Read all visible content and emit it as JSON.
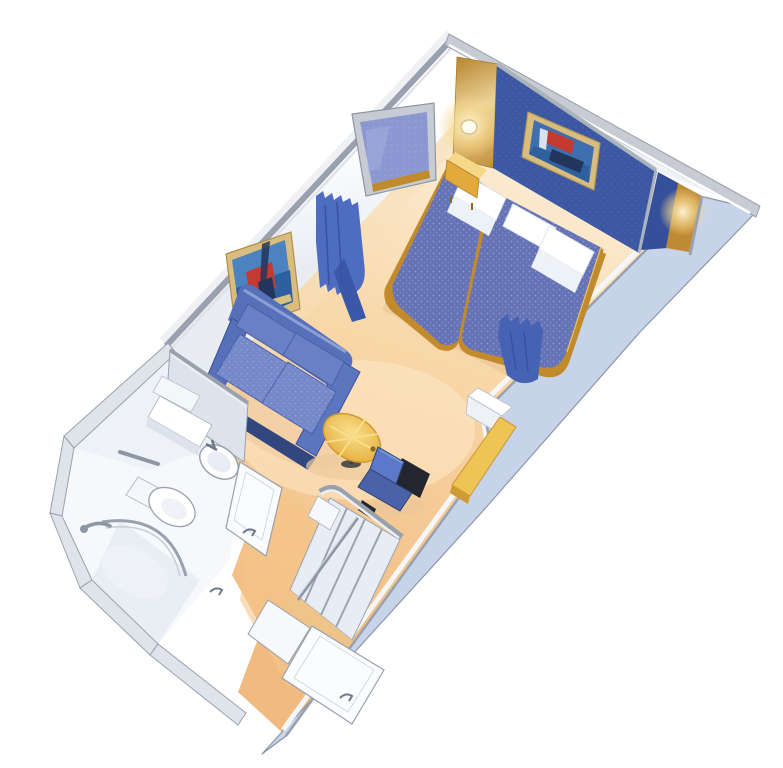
{
  "meta": {
    "title": "Interior stateroom 3D cutaway floor plan",
    "scene_type": "cruise-ship-cabin-illustration",
    "visible_text": ""
  },
  "palette": {
    "background": "#ffffff",
    "floor_light": "#fdf1de",
    "floor_mid": "#f8d7a8",
    "floor_deep": "#f1ba80",
    "corridor_carpet": "#f5c488",
    "outer_wall": "#c7d3e9",
    "wall_trim": "#98a1ad",
    "wall_trim_light": "#c7ccd4",
    "inner_wall_white": "#ffffff",
    "headboard_wall": "#3c58a3",
    "headboard_return": "#35509a",
    "wood_gold": "#c9973f",
    "gold_light": "#f6d988",
    "nightstand": "#e2a93c",
    "bedspread": "#6573b6",
    "bed_base_gold": "#c08a2d",
    "pillow": "#ffffff",
    "sheet": "#edf1f8",
    "sofa": "#5671b9",
    "sofa_cushion": "#7589ca",
    "sofa_dark": "#33477f",
    "curtain": "#4e6cc0",
    "curtain_dark": "#3a57a8",
    "table_top": "#efc355",
    "chair": "#5b79c8",
    "chair_frame": "#23262f",
    "desk": "#eec455",
    "fixture_white": "#ffffff",
    "fixture_shade": "#e2e8f1",
    "fixture_line": "#8d96a4",
    "art_frame": "#d9bd7e",
    "art_sky": "#4c82c0",
    "art_sea": "#2e5f9e",
    "art_red": "#c53a30",
    "art_dark": "#22365c",
    "sconce_glow": "#ffe9b8"
  },
  "objects": [
    {
      "id": "headboard-wall",
      "label": "navy headboard wall with framed nautical print and two wall sconces"
    },
    {
      "id": "bed-left",
      "label": "twin bed, blue spread, white pillow"
    },
    {
      "id": "bed-right",
      "label": "twin bed, blue spread, two white pillows, blue curtain over foot"
    },
    {
      "id": "nightstand",
      "label": "wooden nightstand"
    },
    {
      "id": "wall-mirror",
      "label": "framed mirror reflecting bed"
    },
    {
      "id": "wall-artwork",
      "label": "framed sailboat painting on left wall"
    },
    {
      "id": "divider-curtain",
      "label": "blue privacy curtain"
    },
    {
      "id": "loveseat-sofa",
      "label": "blue two-seat sofa"
    },
    {
      "id": "coffee-table",
      "label": "round golden table"
    },
    {
      "id": "desk-chair",
      "label": "small blue chair at vanity desk"
    },
    {
      "id": "vanity-desk",
      "label": "wooden vanity counter along wall"
    },
    {
      "id": "minibar-cabinet",
      "label": "white cabinet"
    },
    {
      "id": "bathroom",
      "label": "bathroom with sink, toilet, curved shower and towel bar"
    },
    {
      "id": "closet",
      "label": "open wardrobe with dividers and hanging rail"
    },
    {
      "id": "entry-door",
      "label": "cabin entry door"
    }
  ]
}
